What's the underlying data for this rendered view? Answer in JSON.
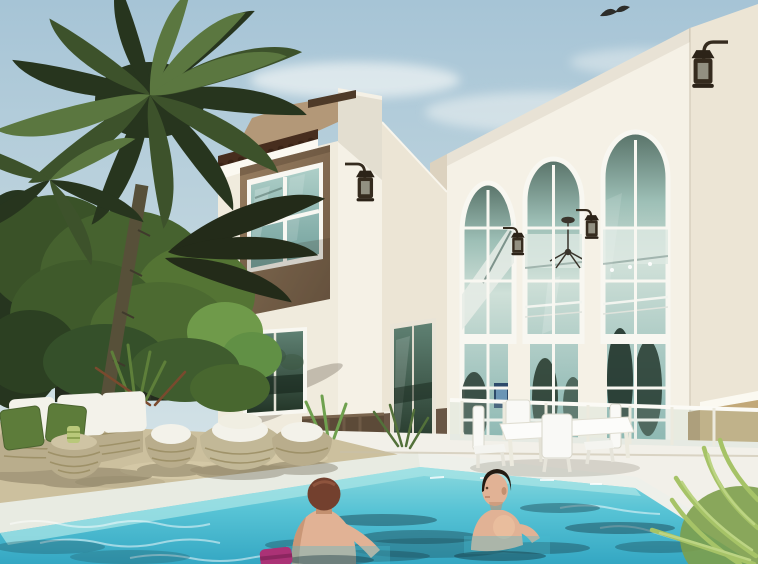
{
  "scene": {
    "description": "Architectural 3D rendering of a white two-storey Mediterranean villa with a taupe-framed picture window, terracotta roof-tile trim, three tall arched windows, wall lanterns, tropical palm trees, wicker patio lounge furniture, a white outdoor dining set, and a man and a woman swimming in a turquoise pool; a bird flies in the pale blue sky",
    "objects": [
      "sky",
      "clouds",
      "flying bird",
      "palm tree",
      "tropical shrubs",
      "garden fence",
      "villa tower",
      "roof tiles",
      "picture window",
      "wall lantern",
      "arched windows",
      "chandelier",
      "pier lanterns",
      "sliding glass doors",
      "brown wainscot",
      "glass pool fence",
      "outdoor dining table",
      "white dining chairs",
      "wicker sofa",
      "green pillows",
      "wicker ottoman",
      "wicker egg chairs",
      "stone sun deck",
      "white patio",
      "pool coping",
      "swimming pool",
      "woman swimmer",
      "man swimmer",
      "pink pool float",
      "fern plant"
    ]
  },
  "colors": {
    "sky_top": "#a6c4d6",
    "sky_mid": "#c6d9e0",
    "sky_horizon": "#dde9ec",
    "cloud": "#ecf2f3",
    "bird": "#2d2d2a",
    "wall_bright": "#f5f1e6",
    "wall_side": "#ece5d5",
    "wall_shade": "#dcd2bf",
    "cornice": "#fbf9f1",
    "parapet_taupe": "#b39878",
    "panel_taupe_light": "#987e60",
    "panel_taupe_dark": "#6e5843",
    "roof_tile": "#472d1e",
    "roof_cap": "#4e3a28",
    "mullion": "#f8f7f1",
    "arch_glass_top": "#587268",
    "arch_glass_hi": "#9dbfb6",
    "arch_glass_mid": "#cfe0d8",
    "arch_glass_low": "#7fafab",
    "win_glass_top": "#aecfc8",
    "win_glass_low": "#6f9e9a",
    "door_glass_top": "#5f8173",
    "door_glass_dark": "#233527",
    "wainscot_brown": "#6a5645",
    "wainscot_tan": "#c2a878",
    "lantern_metal": "#352b1e",
    "palm_dark": "#27351e",
    "palm_mid": "#3d522b",
    "palm_light": "#5b7740",
    "palm_shadow": "#232b19",
    "foliage_bright": "#6f9a4a",
    "fence": "#242b1e",
    "trunk": "#575039",
    "deck_tan": "#ccc09e",
    "patio_white": "#f2f0e9",
    "coping": "#e8ebe2",
    "water_top": "#8cd9de",
    "water_mid": "#57c3d5",
    "water_deep": "#34a7c3",
    "ripple_dark": "#1c4a57",
    "wicker": "#b9ad8c",
    "wicker_line": "#97895f",
    "cushion_white": "#f3f2ea",
    "pillow_green": "#5d7c3a",
    "skin": "#e1b295",
    "skin_shade": "#c3906f",
    "hair_red": "#73402e",
    "hair_dark": "#231a11",
    "furniture_white": "#f9f9f6",
    "accent_magenta": "#ab3276",
    "fern_green": "#a6c367",
    "fern_dark": "#7d9e4b"
  }
}
